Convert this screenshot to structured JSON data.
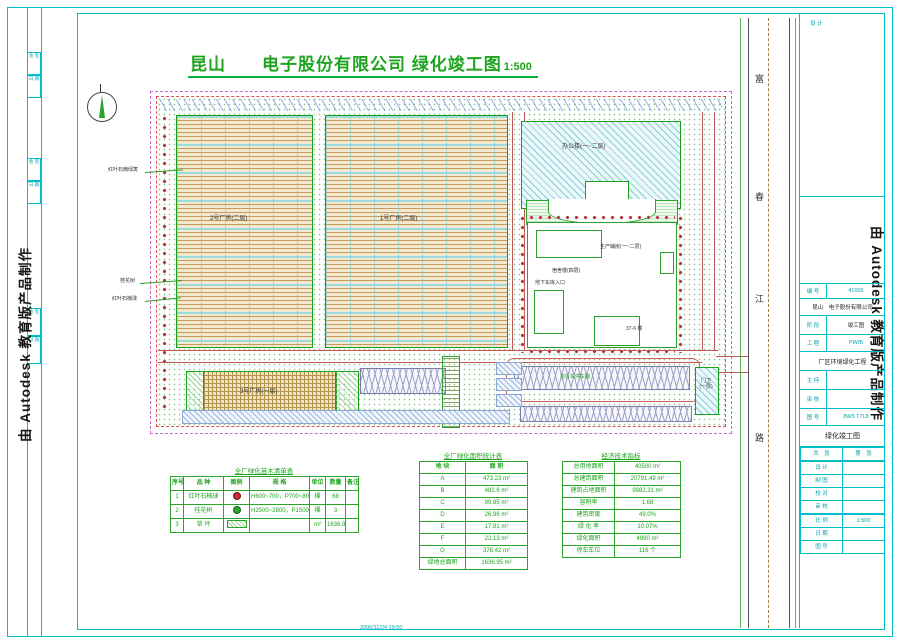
{
  "watermark": {
    "text": "由 Autodesk 教育版产品制作"
  },
  "title": {
    "main": "昆山　　电子股份有限公司  绿化竣工图",
    "scale": "1:500"
  },
  "road": {
    "chars": [
      "富",
      "春",
      "江",
      "路"
    ]
  },
  "plan": {
    "labels": {
      "factory2": "2号厂房(二层)",
      "factory1": "1号厂房(二层)",
      "factory3": "3号厂房(一层)",
      "office": "办公楼(一~二层)",
      "annex": "生产辅房(一~二层)",
      "dorm": "宿舍楼(四层)",
      "garage": "地下车库入口",
      "block376": "37-6 楼",
      "bike": "自行车停车棚",
      "gatehouse_l1": "门卫",
      "gatehouse_l2": "(一层)"
    },
    "annotations": [
      "红叶石楠绿篱",
      "桂花树",
      "红叶石楠球"
    ]
  },
  "plant_table": {
    "title": "全厂绿化苗木清单表",
    "headers": [
      "序号",
      "品 种",
      "图例",
      "规 格",
      "单位",
      "数量",
      "备注"
    ],
    "rows": [
      [
        "1",
        "红叶石楠球",
        "sym:red",
        "H600~700，P700~800",
        "棵",
        "68",
        ""
      ],
      [
        "2",
        "桂花树",
        "sym:green",
        "H2500~2800，P1500~1800",
        "棵",
        "3",
        ""
      ],
      [
        "3",
        "草 坪",
        "sym:hatch",
        "",
        "m²",
        "1636.95",
        ""
      ]
    ]
  },
  "area_table": {
    "title": "全厂绿化面积统计表",
    "headers": [
      "地 块",
      "面 积"
    ],
    "rows": [
      [
        "A",
        "473.23 m²"
      ],
      [
        "B",
        "482.6 m²"
      ],
      [
        "C",
        "99.85 m²"
      ],
      [
        "D",
        "26.96 m²"
      ],
      [
        "E",
        "17.81 m²"
      ],
      [
        "F",
        "22.13 m²"
      ],
      [
        "G",
        "376.42 m²"
      ],
      [
        "绿地总面积",
        "1636.95 m²"
      ]
    ]
  },
  "indicator_table": {
    "title": "经济技术指标",
    "rows": [
      [
        "总用地面积",
        "40500 m²"
      ],
      [
        "总建筑面积",
        "20791.49 m²"
      ],
      [
        "建筑占地面积",
        "9982.31 m²"
      ],
      [
        "容积率",
        "1.68"
      ],
      [
        "建筑密度",
        "49.0%"
      ],
      [
        "绿 化 率",
        "10.07%"
      ],
      [
        "绿化面积",
        "4990 m²"
      ],
      [
        "停车车位",
        "116 个"
      ]
    ]
  },
  "title_block": {
    "top_label": "设 计",
    "project_no_label": "编 号",
    "project_no": "41005",
    "client": "昆山　电子股份有限公司",
    "stage_label": "阶 段",
    "stage": "竣工图",
    "eng_label": "工 程",
    "eng_no": "PW/B",
    "project_name": "厂区环境绿化工程",
    "host_label": "主 持",
    "check_label": "审 核",
    "fig_label": "图 号",
    "fig_no": "8W5 T7L8",
    "drawing_name": "绿化竣工图",
    "sheet_rows": [
      [
        "共　张",
        "第　张"
      ]
    ],
    "sign_rows": [
      [
        "设 计",
        ""
      ],
      [
        "制 图",
        ""
      ],
      [
        "校 对",
        ""
      ],
      [
        "审 核",
        ""
      ]
    ],
    "info_rows": [
      [
        "比 例",
        "1:500"
      ],
      [
        "日 期",
        ""
      ],
      [
        "图 号",
        ""
      ]
    ]
  },
  "margin": {
    "cells": [
      "会 签",
      "日 期"
    ]
  },
  "plot_stamp": "2006/11/24 19:50"
}
